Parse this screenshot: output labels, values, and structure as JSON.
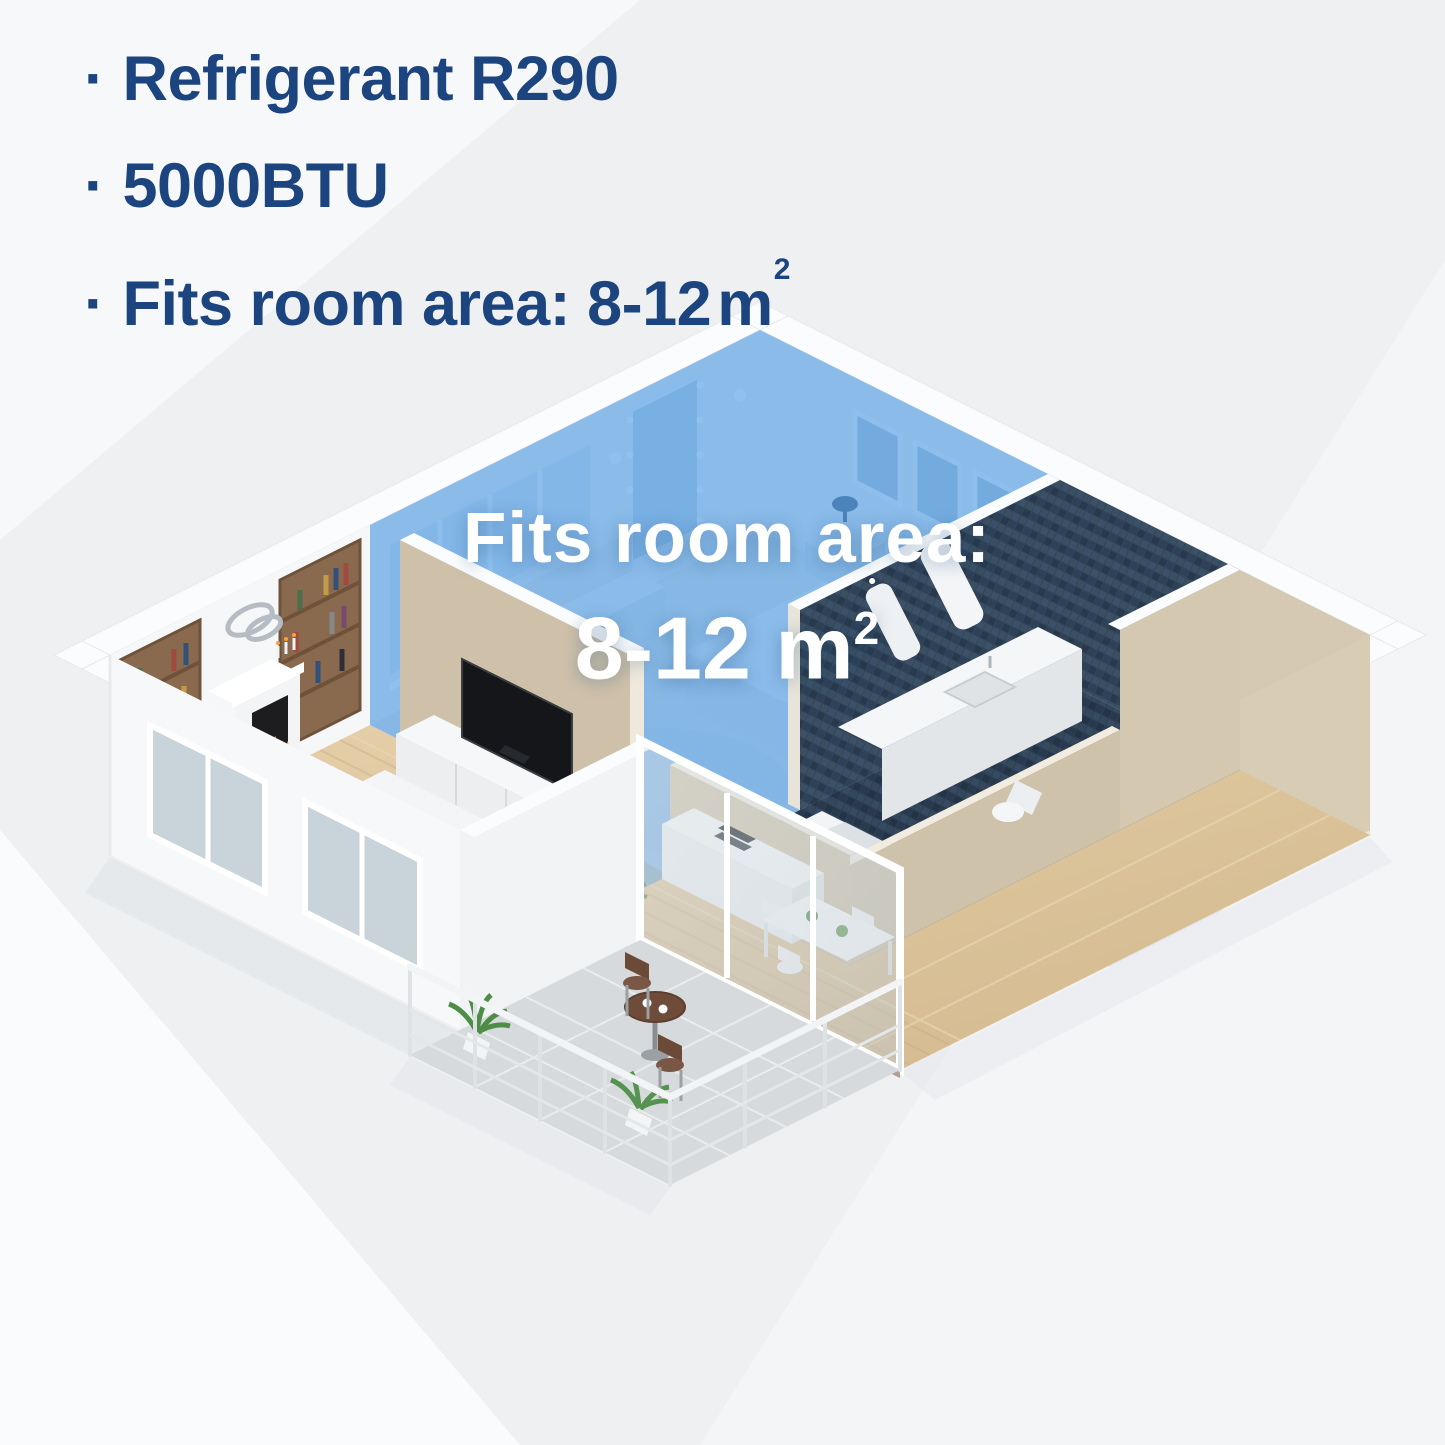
{
  "specs": {
    "bullet": "·",
    "items": [
      {
        "label": "Refrigerant R290"
      },
      {
        "label": "5000BTU"
      },
      {
        "label_prefix": "Fits room area: 8-12",
        "unit": "m",
        "unit_sup": "2"
      }
    ]
  },
  "floor_label": {
    "line1": "Fits room area:",
    "line2_value": "8-12 m",
    "line2_sup": "2"
  },
  "colors": {
    "heading_text": "#1c447e",
    "highlight_blue": "#3f93e0",
    "label_text": "#ffffff",
    "background": "#eef0f2",
    "wood_floor": "#ddc69e",
    "bathroom_tile": "#32455c",
    "wall_beige": "#d2c4ac",
    "wall_white": "#fbfcfd",
    "plant_green": "#559350",
    "fire_orange": "#f5a23c"
  }
}
